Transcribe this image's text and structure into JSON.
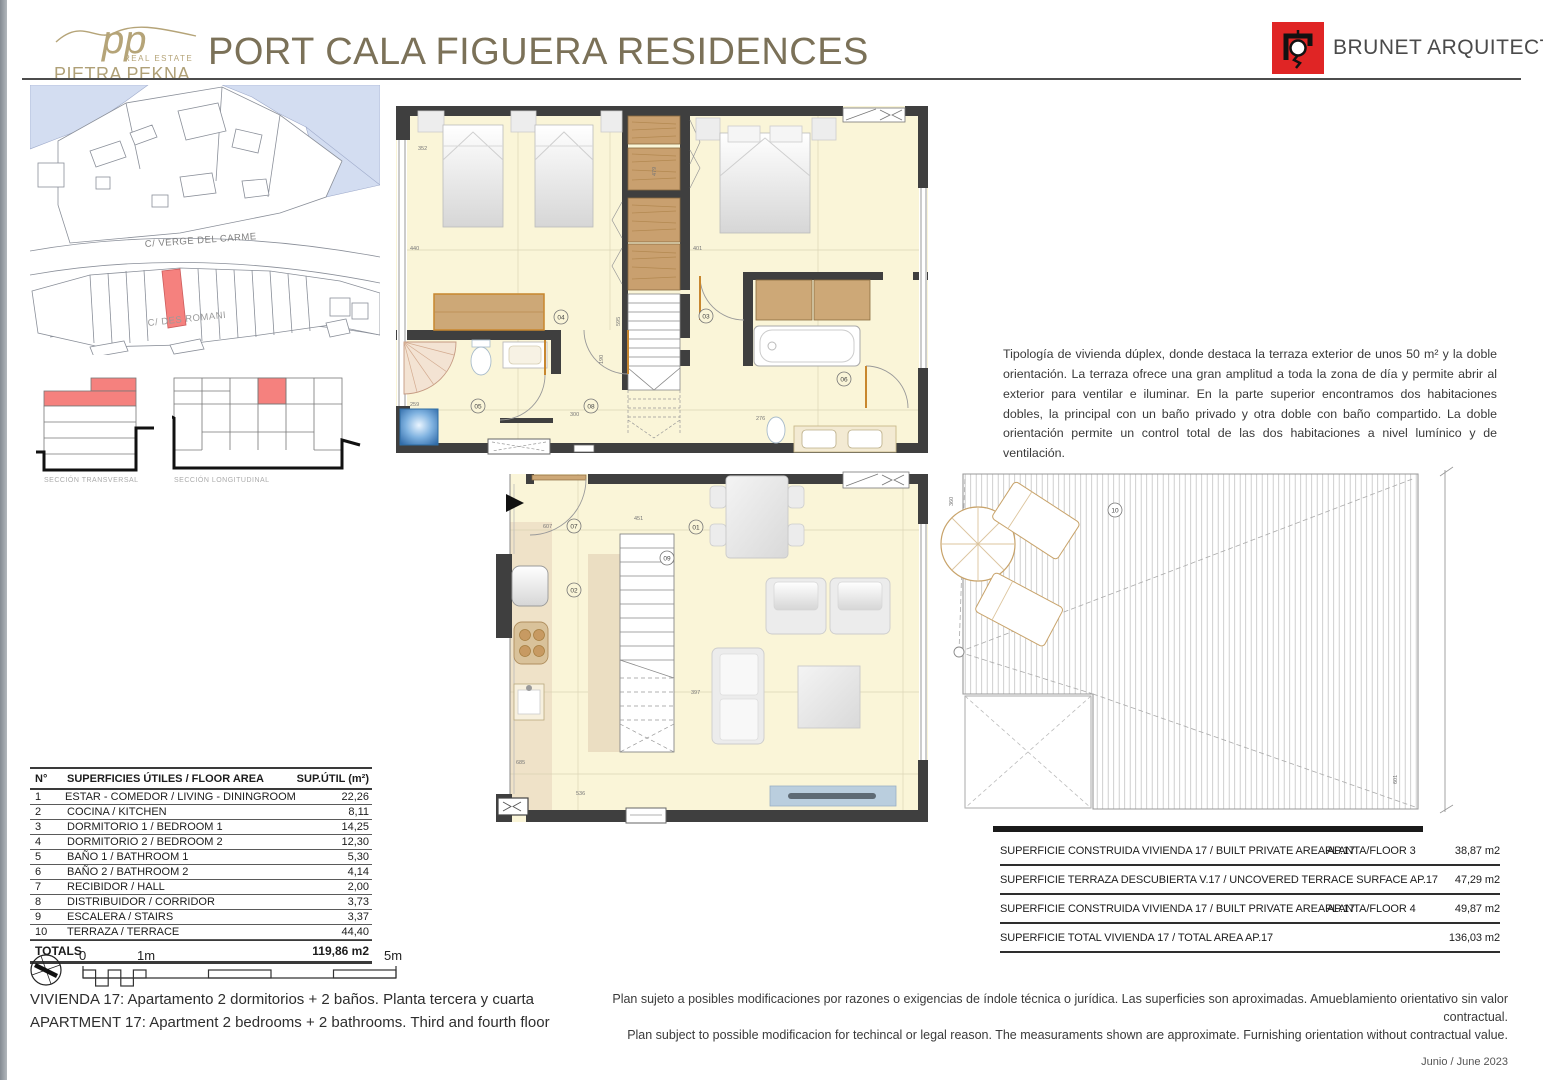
{
  "header": {
    "logo": {
      "initials": "pp",
      "tagline": "REAL ESTATE",
      "name": "PIETRA PEKNA"
    },
    "title": "PORT CALA FIGUERA RESIDENCES",
    "architect": "BRUNET ARQUITECTES"
  },
  "site_map": {
    "street_1": "C/ VERGE DEL CARME",
    "street_2": "C/ DES ROMANI"
  },
  "sections": {
    "transversal": "SECCIÓN TRANSVERSAL",
    "longitudinal": "SECCIÓN LONGITUDINAL"
  },
  "description": "Tipología de vivienda dúplex, donde destaca la terraza exterior de unos 50 m² y la doble orientación. La terraza ofrece una gran amplitud a toda la zona de día y permite abrir al exterior para ventilar e iluminar. En la parte superior encontramos dos habitaciones dobles, la principal con un baño privado y otra doble con baño compartido. La doble orientación permite un control total de las dos habitaciones a nivel lumínico y de ventilación.",
  "area_table": {
    "header": {
      "num": "N°",
      "label": "SUPERFICIES ÚTILES / FLOOR AREA",
      "value": "SUP.ÚTIL (m²)"
    },
    "rows": [
      {
        "num": "1",
        "label": "ESTAR - COMEDOR / LIVING - DININGROOM",
        "value": "22,26"
      },
      {
        "num": "2",
        "label": "COCINA / KITCHEN",
        "value": "8,11"
      },
      {
        "num": "3",
        "label": "DORMITORIO 1 / BEDROOM 1",
        "value": "14,25"
      },
      {
        "num": "4",
        "label": "DORMITORIO 2 / BEDROOM 2",
        "value": "12,30"
      },
      {
        "num": "5",
        "label": "BAÑO 1 / BATHROOM 1",
        "value": "5,30"
      },
      {
        "num": "6",
        "label": "BAÑO 2 / BATHROOM 2",
        "value": "4,14"
      },
      {
        "num": "7",
        "label": "RECIBIDOR / HALL",
        "value": "2,00"
      },
      {
        "num": "8",
        "label": "DISTRIBUIDOR / CORRIDOR",
        "value": "3,73"
      },
      {
        "num": "9",
        "label": "ESCALERA / STAIRS",
        "value": "3,37"
      },
      {
        "num": "10",
        "label": "TERRAZA / TERRACE",
        "value": "44,40"
      }
    ],
    "totals": {
      "label": "TOTALS",
      "value": "119,86 m2"
    }
  },
  "scale_bar": {
    "zero": "0",
    "one": "1m",
    "five": "5m"
  },
  "apartment": {
    "es": "VIVIENDA 17: Apartamento 2 dormitorios + 2 baños. Planta tercera y cuarta",
    "en": "APARTMENT 17: Apartment 2 bedrooms + 2 bathrooms. Third and fourth floor"
  },
  "surface_table": {
    "rows": [
      {
        "label": "SUPERFICIE CONSTRUIDA VIVIENDA 17 / BUILT PRIVATE AREA AP.17",
        "floor": "PLANTA/FLOOR 3",
        "value": "38,87 m2"
      },
      {
        "label": "SUPERFICIE TERRAZA DESCUBIERTA V.17 / UNCOVERED TERRACE SURFACE AP.17",
        "floor": "",
        "value": "47,29 m2"
      },
      {
        "label": "SUPERFICIE CONSTRUIDA VIVIENDA 17 / BUILT PRIVATE AREA AP.17",
        "floor": "PLANTA/FLOOR 4",
        "value": "49,87 m2"
      },
      {
        "label": "SUPERFICIE TOTAL VIVIENDA 17 / TOTAL AREA AP.17",
        "floor": "",
        "value": "136,03 m2"
      }
    ]
  },
  "footer": {
    "disclaimer_es": "Plan sujeto a posibles modificaciones por razones o exigencias de índole técnica o jurídica. Las superficies son aproximadas. Amueblamiento orientativo sin valor contractual.",
    "disclaimer_en": "Plan subject to possible modificacion for techincal or legal reason. The measuraments shown are approximate. Furnishing orientation without contractual value.",
    "date": "Junio / June 2023"
  },
  "plan": {
    "rooms": {
      "n01": "01",
      "n02": "02",
      "n03": "03",
      "n04": "04",
      "n05": "05",
      "n06": "06",
      "n07": "07",
      "n08": "08",
      "n09": "09",
      "n10": "10"
    },
    "dims_upper": {
      "d1": "352",
      "d2": "440",
      "d3": "479",
      "d4": "401",
      "d5": "300",
      "d6": "190",
      "d7": "259",
      "d8": "276",
      "d9": "595"
    },
    "dims_lower": {
      "d1": "607",
      "d2": "451",
      "d3": "397",
      "d4": "685",
      "d5": "536"
    },
    "dims_terrace": {
      "d1": "360",
      "d2": "601"
    }
  },
  "colors": {
    "accent_red": "#E02525",
    "brand_tan": "#B5A478",
    "title_brown": "#7B7158",
    "highlight_red": "#F5817E",
    "water_blue": "#D3DDF1",
    "wall_gray": "#3F3F3F",
    "floor_cream": "#FAF5D8"
  }
}
